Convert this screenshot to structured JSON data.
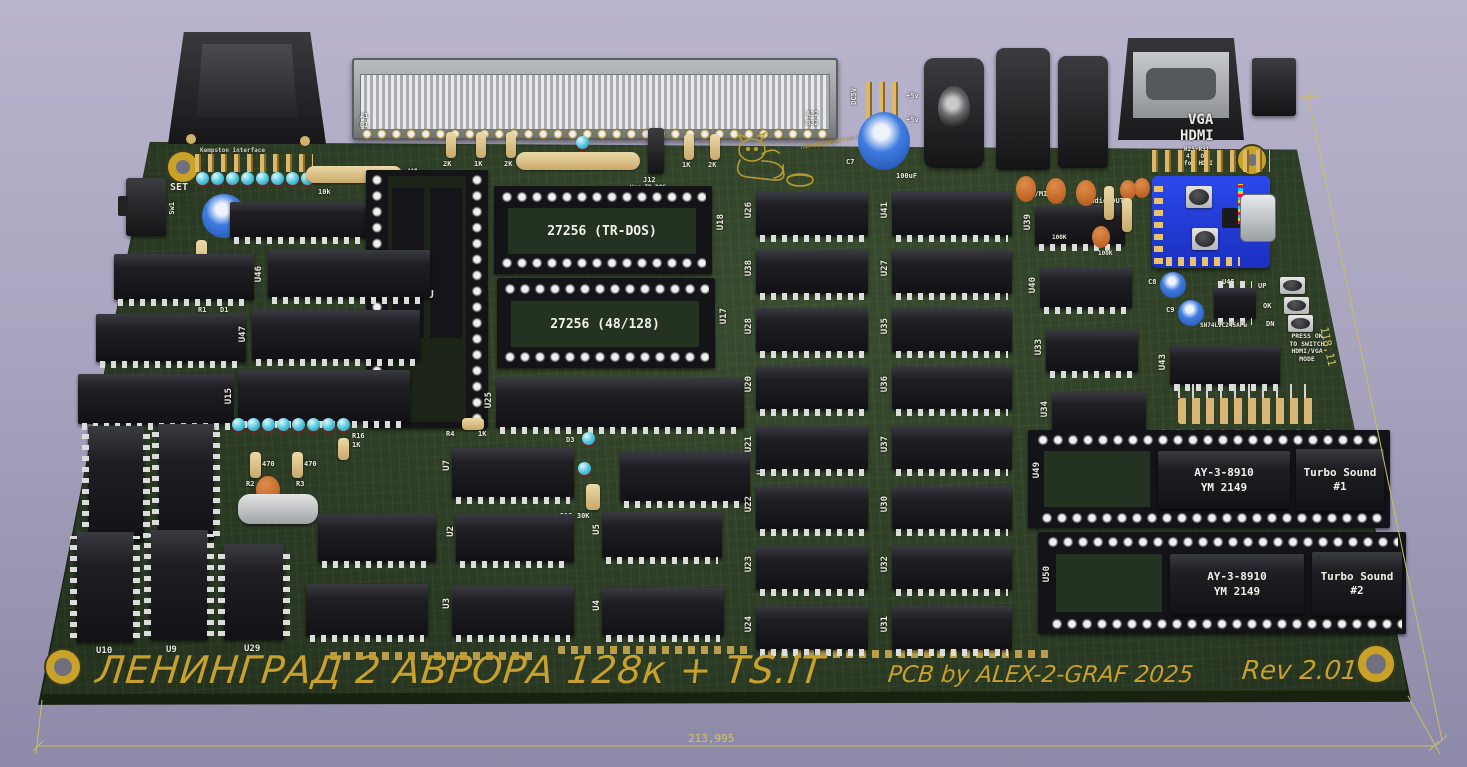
{
  "scene": {
    "background_top": "#bab5cd",
    "background_bottom": "#8d89a8",
    "board_color": "#2c3d26",
    "silkscreen_yellow": "#c7a12b",
    "silkscreen_white": "#eceade",
    "dimension_color": "#d2c468"
  },
  "dimensions": {
    "width_label": "213,995",
    "height_label": "118,11"
  },
  "silkscreen": {
    "title": "ЛЕНИНГРАД 2 АВРОРА 128к + TS.IT",
    "credit": "PCB by ALEX-2-GRAF 2025",
    "rev": "Rev 2.01",
    "kempston": "Kempston interface",
    "cat_note": "покорми котика",
    "a1": "A1",
    "b1": "B1",
    "a32": "A32",
    "b32": "B32",
    "dc5v": "DC5V",
    "p5a": "+5v",
    "p5b": "+5v",
    "dc": "DC 5v",
    "pol": "⊖–⊙–⊕",
    "c7": "C7",
    "c7v": "100uF",
    "earmic": "EAR/MIC",
    "audioout": "Audio OUT",
    "vga": "VGA",
    "hdmi": "HDMI",
    "vnote1": "R25-R31",
    "vnote2": "470 Om",
    "vnote3": "for HDMI",
    "set": "SET",
    "sw1": "Sw1",
    "r1": "R1",
    "d1": "D1",
    "rn2v": "10k",
    "rn2": "RN2",
    "z80": "Z80CPU",
    "rom1": "27256 (TR-DOS)",
    "rom2": "27256 (48/128)",
    "j12": "J12",
    "j12n": "Ver-TR-DOS",
    "rrow": [
      "2K",
      "1K",
      "2K",
      "1K",
      "2K"
    ],
    "r4": "R4",
    "r4v": "1K",
    "d3": "D3",
    "d2": "D2",
    "r12": "R12 30K",
    "r16": "R16",
    "r16v": "1K",
    "r2": "R2",
    "r3": "R3",
    "r2v": "470",
    "r3v": "470",
    "c8": "C8",
    "c9": "C9",
    "sn74": "SN74LVC245APw",
    "btn_up": "UP",
    "btn_ok": "OK",
    "btn_dn": "DN",
    "note_lines": [
      "PRESS OK",
      "TO SWITCH",
      "HDMI/VGA",
      "MODE"
    ],
    "ay": "AY-3-8910",
    "ym": "YM 2149",
    "ts": "Turbo Sound",
    "ts1": "#1",
    "ts2": "#2",
    "k100a": "100K",
    "k100b": "100K"
  },
  "refs": {
    "u1": "U1",
    "u2": "U2",
    "u3": "U3",
    "u4": "U4",
    "u5": "U5",
    "u7": "U7",
    "u8": "U8",
    "u9": "U9",
    "u10": "U10",
    "u15": "U15",
    "u17": "U17",
    "u18": "U18",
    "u20": "U20",
    "u21": "U21",
    "u22": "U22",
    "u23": "U23",
    "u24": "U24",
    "u25": "U25",
    "u26": "U26",
    "u27": "U27",
    "u28": "U28",
    "u29": "U29",
    "u30": "U30",
    "u31": "U31",
    "u32": "U32",
    "u33": "U33",
    "u34": "U34",
    "u35": "U35",
    "u36": "U36",
    "u37": "U37",
    "u38": "U38",
    "u39": "U39",
    "u40": "U40",
    "u41": "U41",
    "u43": "U43",
    "u45": "U45",
    "u46": "U46",
    "u47": "U47",
    "u49": "U49",
    "u50": "U50"
  }
}
